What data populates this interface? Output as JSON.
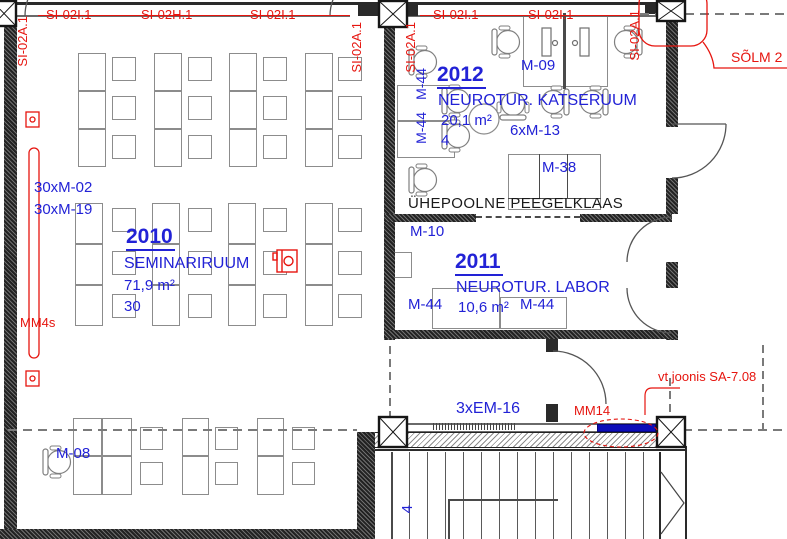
{
  "colors": {
    "red": "#e6150f",
    "blue": "#2222d6",
    "wall": "#222222",
    "furniture_outline": "#8c8c8c",
    "note_text": "#1a1a1a",
    "highlight_bar": "#0d0db8"
  },
  "keynotes_top": [
    "SI-02I.1",
    "SI-02H.1",
    "SI-02I.1",
    "SI-02I.1",
    "SI-02I.1"
  ],
  "keynotes_vertical": [
    "SI-02A.1",
    "SI-02A.1",
    "SI-02A.1",
    "SI-02A.1"
  ],
  "callouts": {
    "solm": "SÕLM 2",
    "mm4s": "MM4s",
    "mm14": "MM14",
    "vt_joonis": "vt joonis SA-7.08"
  },
  "rooms": {
    "seminar": {
      "number": "2010",
      "name": "SEMINARIRUUM",
      "area": "71,9 m²",
      "capacity": "30",
      "tag_chairs_a": "30xM-02",
      "tag_chairs_b": "30xM-19",
      "tag_desk": "M-08"
    },
    "katseruum": {
      "number": "2012",
      "name": "NEUROTUR. KATSERUUM",
      "area": "20,1 m²",
      "capacity": "4",
      "tag_m44_a": "M-44",
      "tag_m44_b": "M-44",
      "tag_workstation": "M-09",
      "tag_chairs": "6xM-13",
      "tag_cabinet": "M-38"
    },
    "labor": {
      "number": "2011",
      "name": "NEUROTUR. LABOR",
      "area": "10,6 m²",
      "tag_m10": "M-10",
      "tag_m44_left": "M-44",
      "tag_m44_right": "M-44"
    }
  },
  "notes": {
    "mirror": "ÜHEPOOLNE PEEGELKLAAS",
    "tag_em16": "3xEM-16",
    "stair_mark": "4"
  }
}
